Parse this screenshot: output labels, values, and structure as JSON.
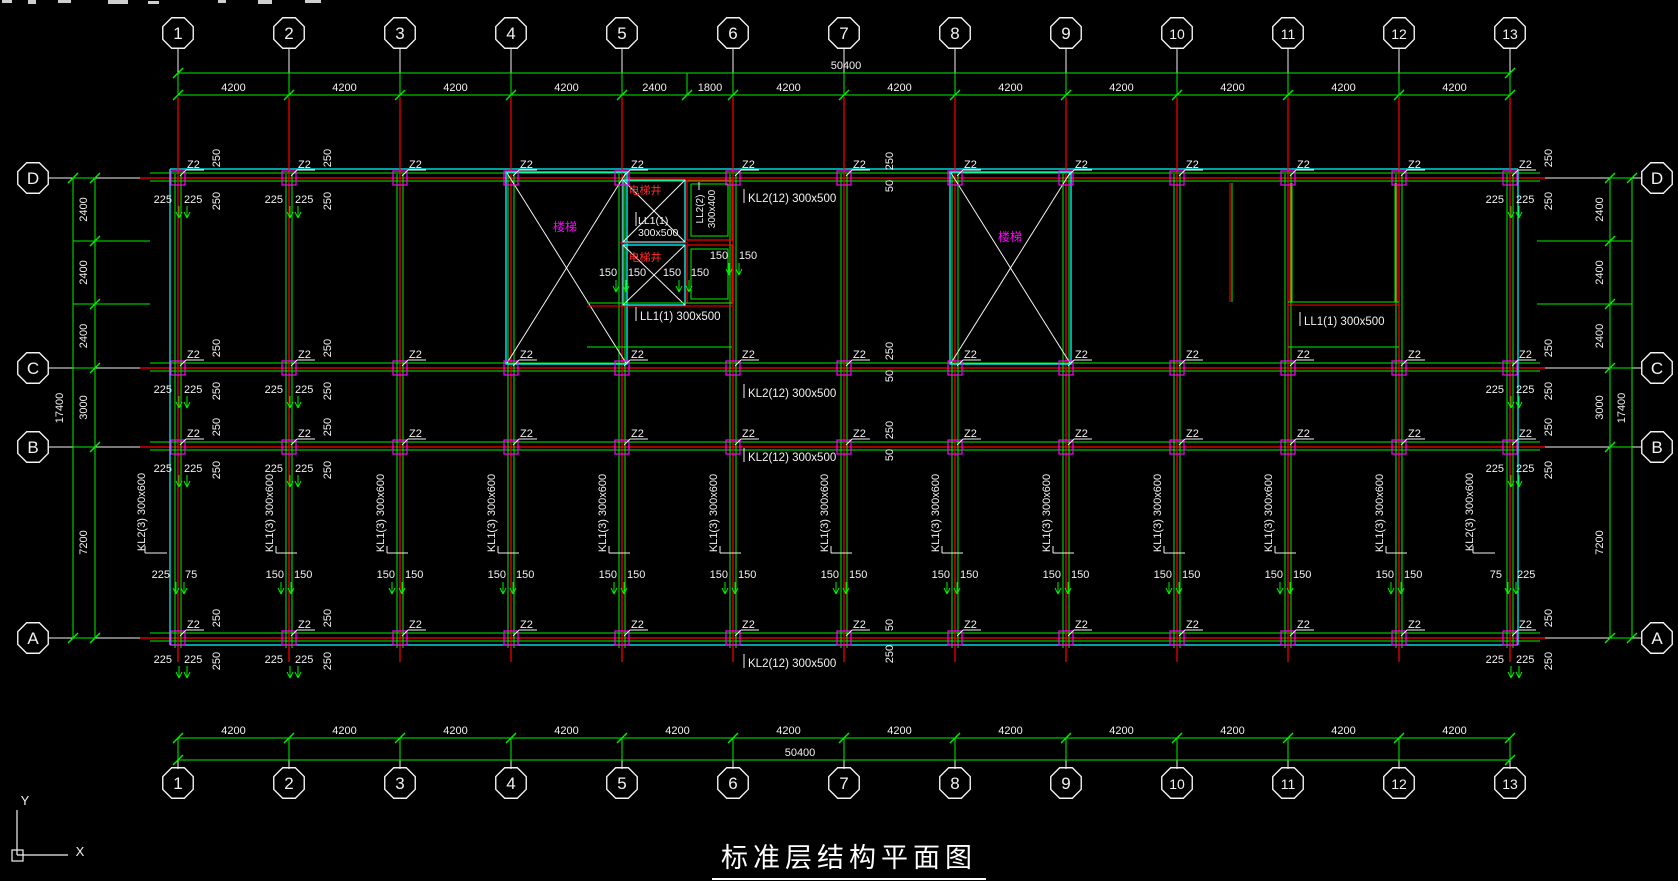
{
  "drawing_title": "标准层结构平面图",
  "colors": {
    "background": "#000000",
    "dim_green": "#00ef00",
    "beam_red": "#ff0000",
    "slab_cyan": "#00ffff",
    "column_magenta": "#ff00ff",
    "text_white": "#f2f2f2",
    "stair_label": "#ff00ff",
    "shaft_label": "#ff2a2a"
  },
  "axes": {
    "columns": {
      "labels": [
        "1",
        "2",
        "3",
        "4",
        "5",
        "6",
        "7",
        "8",
        "9",
        "10",
        "11",
        "12",
        "13"
      ],
      "x": [
        178,
        289,
        400,
        511,
        622,
        733,
        844,
        955,
        1066,
        1177,
        1288,
        1399,
        1510
      ]
    },
    "rows": {
      "labels": [
        "D",
        "C",
        "B",
        "A"
      ],
      "y": [
        178,
        368,
        447,
        638
      ]
    },
    "top_dim": {
      "boundaries": [
        178,
        289,
        400,
        511,
        622,
        687,
        733,
        844,
        955,
        1066,
        1177,
        1288,
        1399,
        1510
      ],
      "segment_labels": [
        "4200",
        "4200",
        "4200",
        "4200",
        "2400",
        "1800",
        "4200",
        "4200",
        "4200",
        "4200",
        "4200",
        "4200",
        "4200"
      ],
      "total": "50400"
    },
    "bottom_dim": {
      "boundaries": [
        178,
        289,
        400,
        511,
        622,
        733,
        844,
        955,
        1066,
        1177,
        1288,
        1399,
        1510
      ],
      "segment_labels": [
        "4200",
        "4200",
        "4200",
        "4200",
        "4200",
        "4200",
        "4200",
        "4200",
        "4200",
        "4200",
        "4200",
        "4200"
      ],
      "total": "50400"
    },
    "left_dim": {
      "boundaries": [
        178,
        241,
        304,
        368,
        447,
        638
      ],
      "segment_labels": [
        "2400",
        "2400",
        "2400",
        "3000",
        "7200"
      ],
      "total": "17400"
    },
    "right_dim": {
      "boundaries": [
        178,
        241,
        304,
        368,
        447,
        638
      ],
      "segment_labels": [
        "2400",
        "2400",
        "2400",
        "3000",
        "7200"
      ],
      "total": "17400"
    }
  },
  "column_tag": "Z2",
  "beam_labels": {
    "horizontal": [
      {
        "text": "KL2(12) 300x500",
        "x": 748,
        "y": 202
      },
      {
        "text": "KL2(12) 300x500",
        "x": 748,
        "y": 397
      },
      {
        "text": "KL2(12) 300x500",
        "x": 748,
        "y": 461
      },
      {
        "text": "KL2(12) 300x500",
        "x": 748,
        "y": 667
      },
      {
        "text": "LL1(1) 300x500",
        "x": 640,
        "y": 320
      },
      {
        "text": "LL1(1) 300x500",
        "x": 1304,
        "y": 325
      }
    ],
    "vertical_kl1": {
      "text": "KL1(3) 300x600",
      "cols": [
        289,
        400,
        511,
        622,
        733,
        844,
        955,
        1066,
        1177,
        1288,
        1399
      ],
      "y": 513
    },
    "vertical_kl2": [
      {
        "text": "KL2(3) 300x600",
        "x": 145,
        "y": 512
      },
      {
        "text": "KL2(3) 300x600",
        "x": 1473,
        "y": 512
      }
    ],
    "shaft_beams": [
      {
        "text": "LL1(1)",
        "x": 638,
        "y": 224
      },
      {
        "text": "300x500",
        "x": 638,
        "y": 236
      }
    ],
    "vertical_ll2": [
      {
        "text": "LL2(2)",
        "x": 703,
        "y": 209
      },
      {
        "text": "300x400",
        "x": 715,
        "y": 209
      }
    ]
  },
  "room_labels": {
    "stairs": [
      {
        "text": "楼梯",
        "x": 565,
        "y": 231
      },
      {
        "text": "楼梯",
        "x": 1010,
        "y": 241
      }
    ],
    "shafts": [
      {
        "text": "电梯井",
        "x": 645,
        "y": 194
      },
      {
        "text": "电梯井",
        "x": 645,
        "y": 261
      }
    ]
  },
  "dim_texts": {
    "pair_225": {
      "label": "225",
      "cols": [
        178,
        289,
        1510
      ],
      "rows": [
        178,
        368,
        447,
        638
      ]
    },
    "rot_250": {
      "label": "250",
      "cols": [
        178,
        289,
        1510
      ],
      "rows": [
        178,
        368,
        447,
        638
      ]
    },
    "mid_cluster": {
      "x": 893,
      "rows_dcb": [
        178,
        368,
        447
      ],
      "above": "250",
      "below": "50",
      "row_a": 638,
      "a_above": "50",
      "a_below": "250"
    },
    "pair_150": {
      "label": "150",
      "y": 578,
      "cols": [
        289,
        400,
        511,
        622,
        733,
        844,
        955,
        1066,
        1177,
        1288,
        1399
      ]
    },
    "edge_pairs": [
      {
        "left": "225",
        "right": "75",
        "x": 178,
        "y": 578
      },
      {
        "left": "75",
        "right": "225",
        "x": 1510,
        "y": 578
      }
    ],
    "shaft_150s": {
      "label": "150",
      "baseline": 276,
      "xs": [
        608,
        637,
        672,
        700
      ]
    },
    "shaft_150_pair": {
      "label": "150",
      "baseline": 259,
      "xs": [
        719,
        748
      ]
    }
  },
  "ucs": {
    "x_label": "X",
    "y_label": "Y"
  }
}
